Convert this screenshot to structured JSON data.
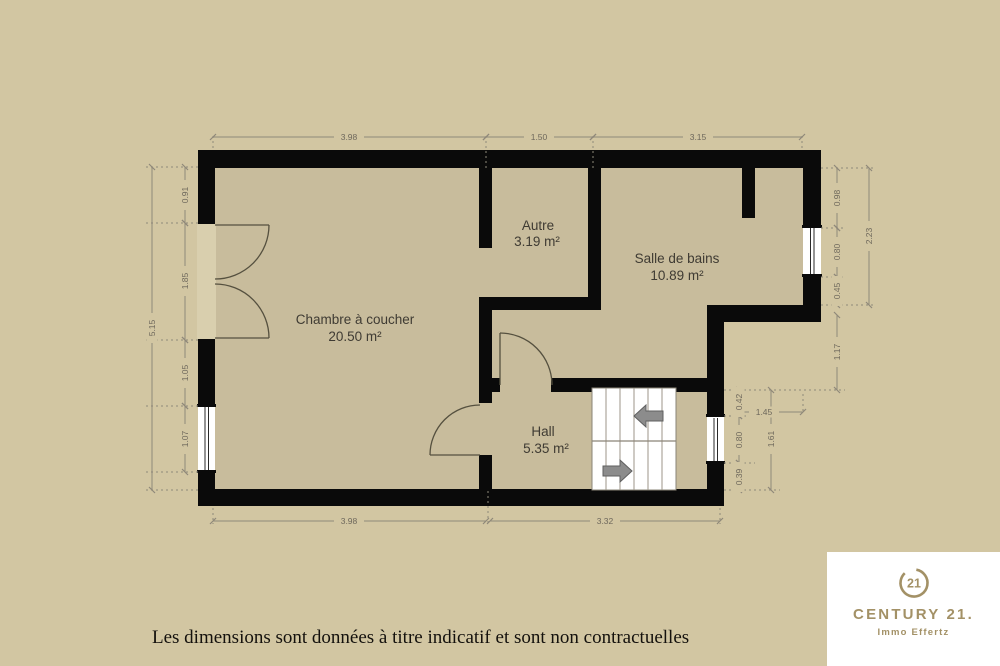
{
  "colors": {
    "background": "#d2c6a2",
    "floor": "#c8bc9c",
    "wall": "#0a0a0a",
    "dimension_lines": "#8f897a",
    "dimension_text": "#6e685c",
    "room_text": "#3f3b33",
    "brand_gold": "#a39166",
    "stairs": "#ffffff"
  },
  "rooms": {
    "bedroom": {
      "name": "Chambre à coucher",
      "area": "20.50 m²"
    },
    "other": {
      "name": "Autre",
      "area": "3.19 m²"
    },
    "bathroom": {
      "name": "Salle de bains",
      "area": "10.89 m²"
    },
    "hall": {
      "name": "Hall",
      "area": "5.35 m²"
    }
  },
  "dims": {
    "top1": "3.98",
    "top2": "1.50",
    "top3": "3.15",
    "bottom1": "3.98",
    "bottom2": "3.32",
    "left_total": "5.15",
    "left1": "0.91",
    "left2": "1.85",
    "left3": "1.05",
    "left4": "1.07",
    "right1": "0.98",
    "right2": "0.80",
    "right3": "0.45",
    "right_total": "2.23",
    "right4": "1.17",
    "stair1": "0.42",
    "stair2": "0.80",
    "stair3": "0.39",
    "stair_total": "1.61",
    "stair_width": "1.45"
  },
  "stairs": {
    "upper_arrow": "left",
    "lower_arrow": "right"
  },
  "footer": {
    "disclaimer": "Les dimensions sont données à titre indicatif et sont non contractuelles"
  },
  "logo": {
    "seal": "21",
    "brand": "CENTURY 21.",
    "agency": "Immo Effertz"
  }
}
